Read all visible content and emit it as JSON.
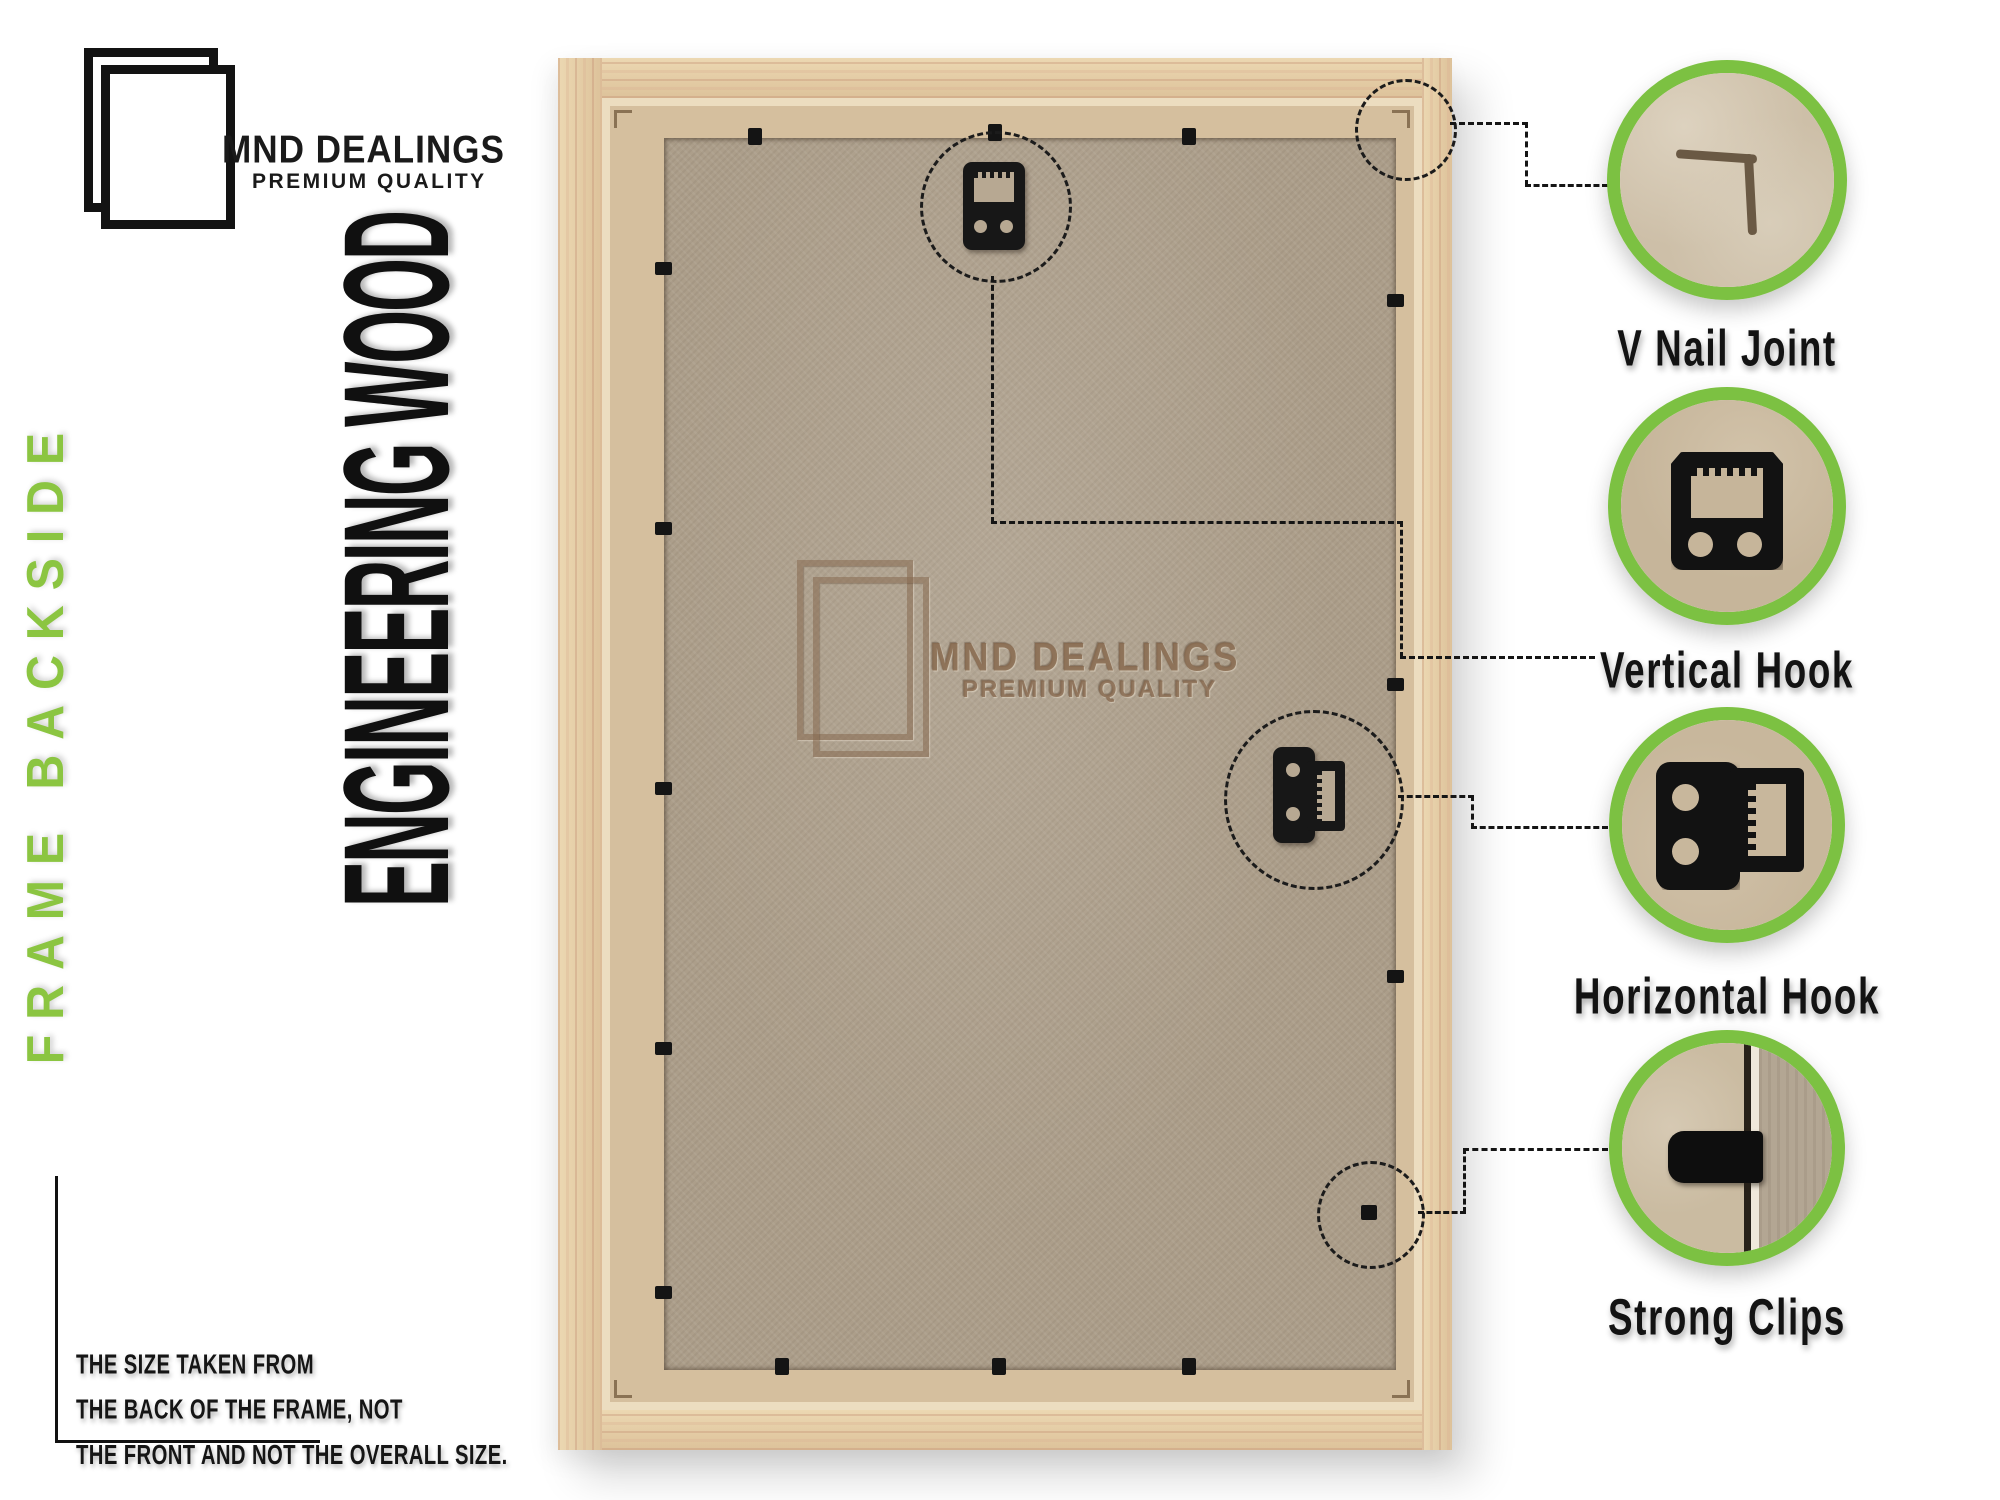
{
  "brand": {
    "name": "MND DEALINGS",
    "tagline": "PREMIUM QUALITY"
  },
  "side_label": "FRAME BACKSIDE",
  "material_label": "ENGINEERING WOOD",
  "watermark": {
    "name": "MND DEALINGS",
    "tagline": "PREMIUM QUALITY"
  },
  "callouts": [
    {
      "id": "v-nail-joint",
      "label": "V Nail Joint"
    },
    {
      "id": "vertical-hook",
      "label": "Vertical Hook"
    },
    {
      "id": "horizontal-hook",
      "label": "Horizontal Hook"
    },
    {
      "id": "strong-clips",
      "label": "Strong Clips"
    }
  ],
  "note": {
    "lines": [
      "THE SIZE TAKEN FROM",
      "THE BACK OF THE FRAME, NOT",
      "THE FRONT AND NOT THE OVERALL SIZE."
    ]
  },
  "colors": {
    "accent_green": "#7cc142",
    "side_label_green": "#8bc541",
    "wood": "#e3cba5",
    "rebate_tan": "#d5bf9e",
    "board": "#ac9e8a",
    "ink": "#141414"
  }
}
